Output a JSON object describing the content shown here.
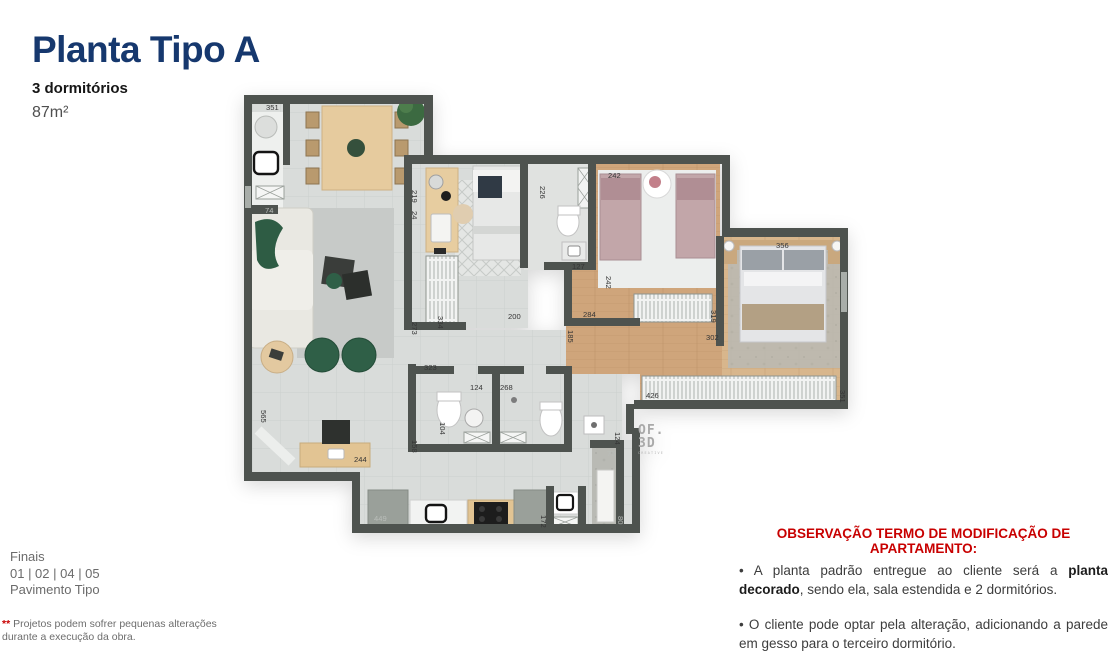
{
  "header": {
    "title": "Planta Tipo A",
    "subtitle": "3 dormitórios",
    "area": "87m²"
  },
  "finais": {
    "line1": "Finais",
    "line2": "01 | 02 | 04 | 05",
    "line3": "Pavimento Tipo"
  },
  "footnote": {
    "mark": "**",
    "text": " Projetos podem sofrer pequenas alterações durante a execução da obra."
  },
  "observation": {
    "heading": "OBSERVAÇÃO TERMO DE MODIFICAÇÃO DE APARTAMENTO:",
    "bullet1_pre": "•  A planta padrão entregue ao cliente será a ",
    "bullet1_bold": "planta decorado",
    "bullet1_post": ", sendo ela, sala estendida e 2 dormitórios.",
    "bullet2": "• O cliente pode optar pela alteração, adicionando a parede em gesso para o terceiro dormitório."
  },
  "plan": {
    "logo_line1": "OF.",
    "logo_line2": "3D",
    "logo_sub": "CREATIVE",
    "dimensions": [
      {
        "label": "351",
        "x": 266,
        "y": 110,
        "rot": 0,
        "light": false
      },
      {
        "label": "74",
        "x": 265,
        "y": 213,
        "rot": 0,
        "light": true
      },
      {
        "label": "219",
        "x": 412,
        "y": 190,
        "rot": 90,
        "light": false
      },
      {
        "label": "24",
        "x": 412,
        "y": 211,
        "rot": 90,
        "light": false
      },
      {
        "label": "226",
        "x": 540,
        "y": 186,
        "rot": 90,
        "light": false
      },
      {
        "label": "242",
        "x": 608,
        "y": 178,
        "rot": 0,
        "light": false
      },
      {
        "label": "356",
        "x": 776,
        "y": 248,
        "rot": 0,
        "light": false
      },
      {
        "label": "127",
        "x": 572,
        "y": 269,
        "rot": 0,
        "light": false
      },
      {
        "label": "242",
        "x": 606,
        "y": 276,
        "rot": 90,
        "light": false
      },
      {
        "label": "273",
        "x": 412,
        "y": 322,
        "rot": 90,
        "light": false
      },
      {
        "label": "334",
        "x": 438,
        "y": 316,
        "rot": 90,
        "light": false
      },
      {
        "label": "200",
        "x": 508,
        "y": 319,
        "rot": 0,
        "light": false
      },
      {
        "label": "284",
        "x": 583,
        "y": 317,
        "rot": 0,
        "light": false
      },
      {
        "label": "185",
        "x": 568,
        "y": 330,
        "rot": 90,
        "light": false
      },
      {
        "label": "319",
        "x": 711,
        "y": 310,
        "rot": 90,
        "light": false
      },
      {
        "label": "302",
        "x": 706,
        "y": 340,
        "rot": 0,
        "light": false
      },
      {
        "label": "426",
        "x": 646,
        "y": 398,
        "rot": 0,
        "light": false
      },
      {
        "label": "351",
        "x": 840,
        "y": 390,
        "rot": 90,
        "light": false
      },
      {
        "label": "323",
        "x": 424,
        "y": 370,
        "rot": 0,
        "light": false
      },
      {
        "label": "124",
        "x": 470,
        "y": 390,
        "rot": 0,
        "light": false
      },
      {
        "label": "268",
        "x": 500,
        "y": 390,
        "rot": 0,
        "light": false
      },
      {
        "label": "104",
        "x": 440,
        "y": 422,
        "rot": 90,
        "light": false
      },
      {
        "label": "158",
        "x": 412,
        "y": 440,
        "rot": 90,
        "light": false
      },
      {
        "label": "244",
        "x": 354,
        "y": 462,
        "rot": 0,
        "light": false
      },
      {
        "label": "565",
        "x": 261,
        "y": 410,
        "rot": 90,
        "light": false
      },
      {
        "label": "124",
        "x": 615,
        "y": 432,
        "rot": 90,
        "light": false
      },
      {
        "label": "76",
        "x": 607,
        "y": 456,
        "rot": 0,
        "light": true
      },
      {
        "label": "80",
        "x": 618,
        "y": 516,
        "rot": 90,
        "light": true
      },
      {
        "label": "449",
        "x": 374,
        "y": 521,
        "rot": 0,
        "light": true
      },
      {
        "label": "172",
        "x": 541,
        "y": 515,
        "rot": 90,
        "light": false
      }
    ]
  },
  "colors": {
    "title_navy": "#16386e",
    "alert_red": "#c80000",
    "wall_gray": "#4e534f",
    "floor_tile": "#d9dcda",
    "wood": "#cfa57b",
    "plant_green": "#2f5f47",
    "bed_mauve": "#c2a6a9",
    "muted_text": "#6b6b6b"
  }
}
